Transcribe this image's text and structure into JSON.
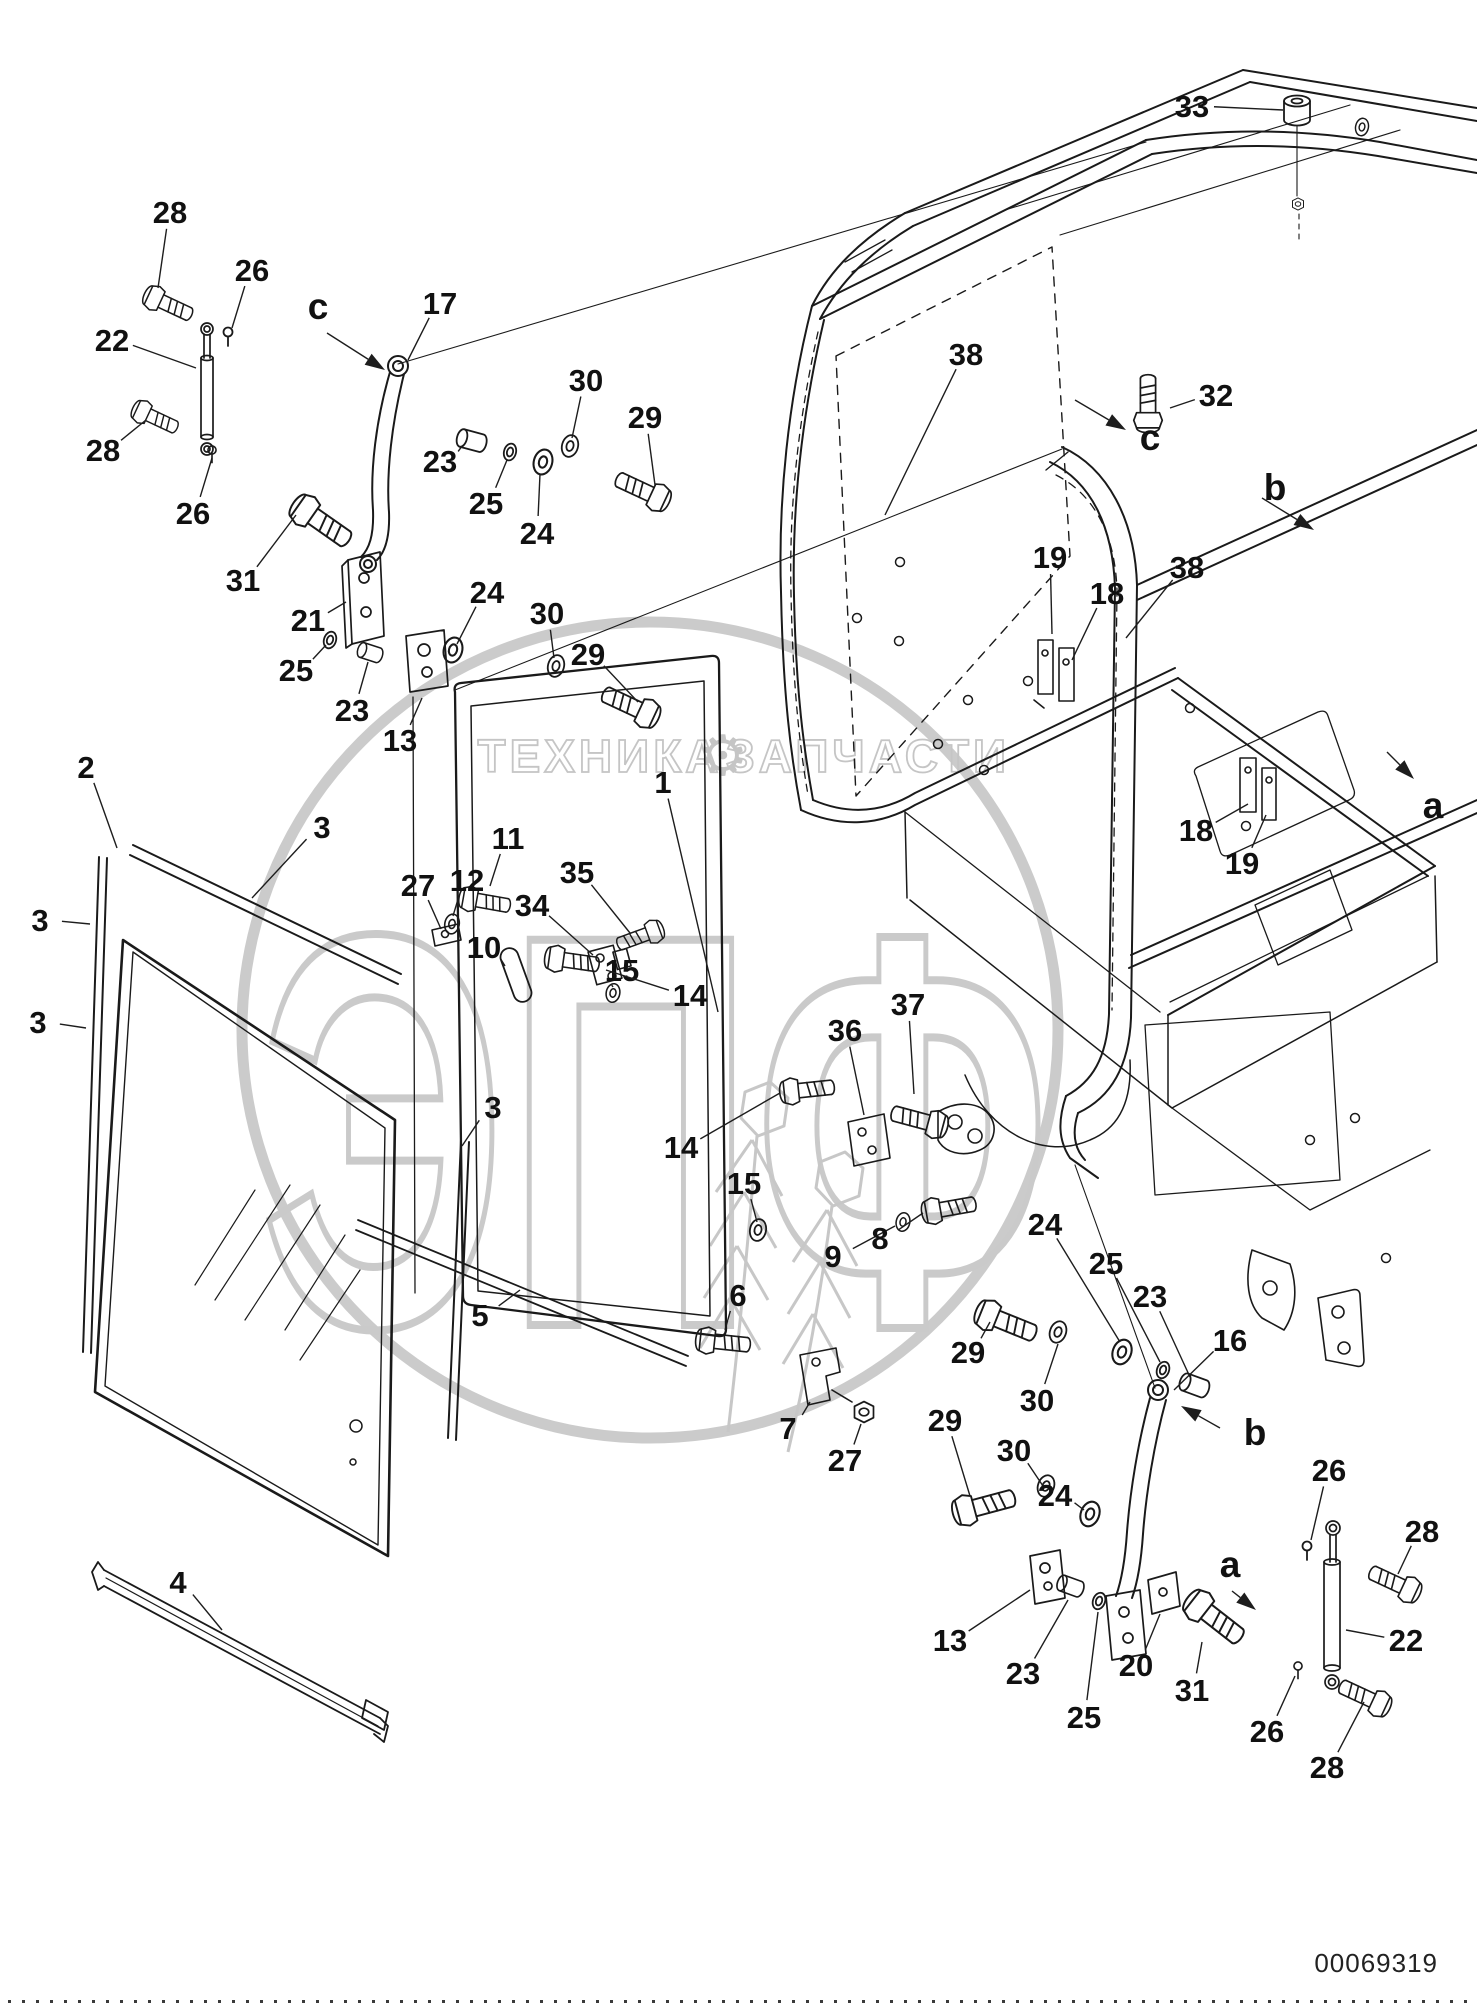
{
  "page": {
    "width": 1477,
    "height": 2008,
    "background": "#ffffff",
    "line_color": "#1a1a1a",
    "id_number": "00069319"
  },
  "watermark": {
    "brand_left": "ТЕХНИКА",
    "brand_right": "ЗАПЧАСТИ",
    "gear_icon": "⚙",
    "logo_text": "ЭПФ",
    "color": "#c8c8c8"
  },
  "callouts": [
    {
      "n": "28",
      "x": 170,
      "y": 212,
      "tx": 158,
      "ty": 288
    },
    {
      "n": "26",
      "x": 252,
      "y": 270,
      "tx": 232,
      "ty": 328
    },
    {
      "n": "c_note",
      "x": 0,
      "y": 0,
      "tx": null,
      "ty": null
    },
    {
      "n": "17",
      "x": 440,
      "y": 303,
      "tx": 408,
      "ty": 360
    },
    {
      "n": "22",
      "x": 112,
      "y": 340,
      "tx": 196,
      "ty": 368
    },
    {
      "n": "28",
      "x": 103,
      "y": 450,
      "tx": 146,
      "ty": 420
    },
    {
      "n": "26",
      "x": 193,
      "y": 513,
      "tx": 212,
      "ty": 458
    },
    {
      "n": "30",
      "x": 586,
      "y": 380,
      "tx": 572,
      "ty": 438
    },
    {
      "n": "29",
      "x": 645,
      "y": 417,
      "tx": 655,
      "ty": 485
    },
    {
      "n": "31",
      "x": 243,
      "y": 580,
      "tx": 296,
      "ty": 515
    },
    {
      "n": "21",
      "x": 308,
      "y": 620,
      "tx": 346,
      "ty": 602
    },
    {
      "n": "25",
      "x": 296,
      "y": 670,
      "tx": 326,
      "ty": 645
    },
    {
      "n": "23",
      "x": 352,
      "y": 710,
      "tx": 368,
      "ty": 662
    },
    {
      "n": "13",
      "x": 400,
      "y": 740,
      "tx": 422,
      "ty": 698
    },
    {
      "n": "23",
      "x": 440,
      "y": 461,
      "tx": 462,
      "ty": 446
    },
    {
      "n": "25",
      "x": 486,
      "y": 503,
      "tx": 507,
      "ty": 460
    },
    {
      "n": "24",
      "x": 537,
      "y": 533,
      "tx": 540,
      "ty": 474
    },
    {
      "n": "24",
      "x": 487,
      "y": 592,
      "tx": 457,
      "ty": 644
    },
    {
      "n": "30",
      "x": 547,
      "y": 613,
      "tx": 554,
      "ty": 658
    },
    {
      "n": "29",
      "x": 588,
      "y": 654,
      "tx": 638,
      "ty": 702
    },
    {
      "n": "2",
      "x": 86,
      "y": 767,
      "tx": 117,
      "ty": 848
    },
    {
      "n": "3",
      "x": 322,
      "y": 827,
      "tx": 252,
      "ty": 898
    },
    {
      "n": "3",
      "x": 40,
      "y": 920,
      "tx": 90,
      "ty": 924
    },
    {
      "n": "3",
      "x": 38,
      "y": 1022,
      "tx": 86,
      "ty": 1028
    },
    {
      "n": "3",
      "x": 493,
      "y": 1107,
      "tx": 462,
      "ty": 1146
    },
    {
      "n": "4",
      "x": 178,
      "y": 1582,
      "tx": 222,
      "ty": 1630
    },
    {
      "n": "1",
      "x": 663,
      "y": 782,
      "tx": 718,
      "ty": 1012
    },
    {
      "n": "35",
      "x": 577,
      "y": 872,
      "tx": 630,
      "ty": 933
    },
    {
      "n": "34",
      "x": 532,
      "y": 905,
      "tx": 593,
      "ty": 955
    },
    {
      "n": "15",
      "x": 622,
      "y": 970,
      "tx": 613,
      "ty": 987
    },
    {
      "n": "14",
      "x": 690,
      "y": 995,
      "tx": 606,
      "ty": 970
    },
    {
      "n": "11",
      "x": 508,
      "y": 838,
      "tx": 490,
      "ty": 886
    },
    {
      "n": "12",
      "x": 467,
      "y": 880,
      "tx": 453,
      "ty": 916
    },
    {
      "n": "10",
      "x": 484,
      "y": 947,
      "tx": 505,
      "ty": 966
    },
    {
      "n": "27",
      "x": 418,
      "y": 885,
      "tx": 441,
      "ty": 929
    },
    {
      "n": "36",
      "x": 845,
      "y": 1030,
      "tx": 864,
      "ty": 1115
    },
    {
      "n": "37",
      "x": 908,
      "y": 1004,
      "tx": 914,
      "ty": 1094
    },
    {
      "n": "15",
      "x": 744,
      "y": 1183,
      "tx": 757,
      "ty": 1222
    },
    {
      "n": "14",
      "x": 681,
      "y": 1147,
      "tx": 780,
      "ty": 1093
    },
    {
      "n": "6",
      "x": 738,
      "y": 1295,
      "tx": 725,
      "ty": 1330
    },
    {
      "n": "9",
      "x": 833,
      "y": 1256,
      "tx": 895,
      "ty": 1226
    },
    {
      "n": "8",
      "x": 880,
      "y": 1238,
      "tx": 923,
      "ty": 1213
    },
    {
      "n": "5",
      "x": 480,
      "y": 1315,
      "tx": 520,
      "ty": 1290
    },
    {
      "n": "7",
      "x": 788,
      "y": 1428,
      "tx": 810,
      "ty": 1402
    },
    {
      "n": "27",
      "x": 845,
      "y": 1460,
      "tx": 861,
      "ty": 1424
    },
    {
      "n": "33",
      "x": 1192,
      "y": 106,
      "tx": 1283,
      "ty": 110
    },
    {
      "n": "38",
      "x": 966,
      "y": 354,
      "tx": 885,
      "ty": 515
    },
    {
      "n": "32",
      "x": 1216,
      "y": 395,
      "tx": 1170,
      "ty": 408
    },
    {
      "n": "19",
      "x": 1050,
      "y": 557,
      "tx": 1052,
      "ty": 634
    },
    {
      "n": "18",
      "x": 1107,
      "y": 593,
      "tx": 1072,
      "ty": 660
    },
    {
      "n": "38",
      "x": 1187,
      "y": 567,
      "tx": 1126,
      "ty": 638
    },
    {
      "n": "18",
      "x": 1196,
      "y": 830,
      "tx": 1248,
      "ty": 804
    },
    {
      "n": "19",
      "x": 1242,
      "y": 863,
      "tx": 1266,
      "ty": 815
    },
    {
      "n": "16",
      "x": 1230,
      "y": 1340,
      "tx": 1174,
      "ty": 1390
    },
    {
      "n": "24",
      "x": 1045,
      "y": 1224,
      "tx": 1120,
      "ty": 1342
    },
    {
      "n": "25",
      "x": 1106,
      "y": 1263,
      "tx": 1160,
      "ty": 1362
    },
    {
      "n": "23",
      "x": 1150,
      "y": 1296,
      "tx": 1190,
      "ty": 1377
    },
    {
      "n": "29",
      "x": 968,
      "y": 1352,
      "tx": 990,
      "ty": 1322
    },
    {
      "n": "30",
      "x": 1037,
      "y": 1400,
      "tx": 1058,
      "ty": 1344
    },
    {
      "n": "29",
      "x": 945,
      "y": 1420,
      "tx": 970,
      "ty": 1496
    },
    {
      "n": "30",
      "x": 1014,
      "y": 1450,
      "tx": 1043,
      "ty": 1486
    },
    {
      "n": "24",
      "x": 1055,
      "y": 1495,
      "tx": 1084,
      "ty": 1510
    },
    {
      "n": "13",
      "x": 950,
      "y": 1640,
      "tx": 1030,
      "ty": 1590
    },
    {
      "n": "23",
      "x": 1023,
      "y": 1673,
      "tx": 1068,
      "ty": 1600
    },
    {
      "n": "25",
      "x": 1084,
      "y": 1717,
      "tx": 1098,
      "ty": 1612
    },
    {
      "n": "20",
      "x": 1136,
      "y": 1665,
      "tx": 1160,
      "ty": 1614
    },
    {
      "n": "31",
      "x": 1192,
      "y": 1690,
      "tx": 1202,
      "ty": 1642
    },
    {
      "n": "26",
      "x": 1329,
      "y": 1470,
      "tx": 1311,
      "ty": 1540
    },
    {
      "n": "28",
      "x": 1422,
      "y": 1531,
      "tx": 1398,
      "ty": 1574
    },
    {
      "n": "22",
      "x": 1406,
      "y": 1640,
      "tx": 1346,
      "ty": 1630
    },
    {
      "n": "26",
      "x": 1267,
      "y": 1731,
      "tx": 1295,
      "ty": 1676
    },
    {
      "n": "28",
      "x": 1327,
      "y": 1767,
      "tx": 1364,
      "ty": 1702
    }
  ],
  "view_labels": [
    {
      "n": "c",
      "x": 318,
      "y": 306,
      "tail_x": 327,
      "tail_y": 333,
      "tip_x": 385,
      "tip_y": 370
    },
    {
      "n": "c",
      "x": 1150,
      "y": 437,
      "tail_x": 1075,
      "tail_y": 400,
      "tip_x": 1126,
      "tip_y": 430
    },
    {
      "n": "b",
      "x": 1275,
      "y": 487,
      "tail_x": 1262,
      "tail_y": 498,
      "tip_x": 1314,
      "tip_y": 530
    },
    {
      "n": "a",
      "x": 1433,
      "y": 805,
      "tail_x": 1387,
      "tail_y": 752,
      "tip_x": 1414,
      "tip_y": 779
    },
    {
      "n": "b",
      "x": 1255,
      "y": 1432,
      "tail_x": 1220,
      "tail_y": 1428,
      "tip_x": 1181,
      "tip_y": 1406
    },
    {
      "n": "a",
      "x": 1230,
      "y": 1564,
      "tail_x": 1232,
      "tail_y": 1591,
      "tip_x": 1256,
      "tip_y": 1610
    }
  ]
}
